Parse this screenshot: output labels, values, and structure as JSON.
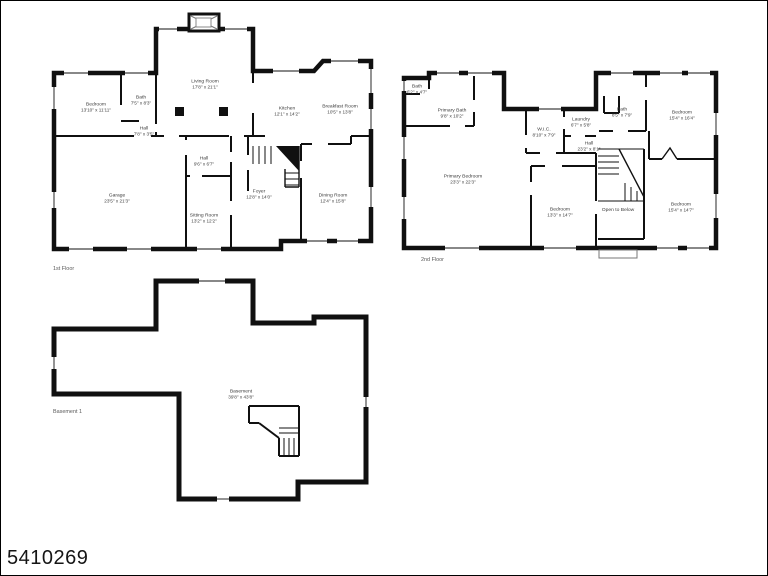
{
  "watermark": "5410269",
  "colors": {
    "walls": "#101010",
    "background": "#ffffff",
    "label_text": "#3c3c3c"
  },
  "floors": {
    "first": {
      "label": "1st Floor",
      "rooms": {
        "bedroom": {
          "name": "Bedroom",
          "dims": "13'10\" x 11'11\""
        },
        "bath": {
          "name": "Bath",
          "dims": "7'5\" x 8'3\""
        },
        "hall_upper": {
          "name": "Hall",
          "dims": "7'8\" x 3'5\""
        },
        "living": {
          "name": "Living Room",
          "dims": "17'8\" x 21'1\""
        },
        "kitchen": {
          "name": "Kitchen",
          "dims": "12'1\" x 14'2\""
        },
        "breakfast": {
          "name": "Breakfast Room",
          "dims": "10'5\" x 13'8\""
        },
        "hall_lower": {
          "name": "Hall",
          "dims": "9'6\" x 6'7\""
        },
        "garage": {
          "name": "Garage",
          "dims": "23'5\" x 21'3\""
        },
        "sitting": {
          "name": "Sitting Room",
          "dims": "13'2\" x 12'2\""
        },
        "foyer": {
          "name": "Foyer",
          "dims": "12'8\" x 14'0\""
        },
        "dining": {
          "name": "Dining Room",
          "dims": "12'4\" x 15'8\""
        }
      }
    },
    "second": {
      "label": "2nd Floor",
      "rooms": {
        "bath_small": {
          "name": "Bath",
          "dims": "6'2\" x 4'7\""
        },
        "primary_bath": {
          "name": "Primary Bath",
          "dims": "9'8\" x 10'2\""
        },
        "wic": {
          "name": "W.I.C.",
          "dims": "8'10\" x 7'9\""
        },
        "laundry": {
          "name": "Laundry",
          "dims": "6'7\" x 5'8\""
        },
        "bath": {
          "name": "Bath",
          "dims": "8'5\" x 7'9\""
        },
        "bedroom_tr": {
          "name": "Bedroom",
          "dims": "15'4\" x 16'4\""
        },
        "hall": {
          "name": "Hall",
          "dims": "23'2\" x 8'1\""
        },
        "primary_bedroom": {
          "name": "Primary Bedroom",
          "dims": "23'3\" x 22'3\""
        },
        "bedroom_bm": {
          "name": "Bedroom",
          "dims": "13'3\" x 14'7\""
        },
        "open_below": {
          "name": "Open to Below"
        },
        "bedroom_br": {
          "name": "Bedroom",
          "dims": "15'4\" x 14'7\""
        }
      }
    },
    "basement": {
      "label": "Basement 1",
      "rooms": {
        "basement": {
          "name": "Basement",
          "dims": "39'8\" x 43'8\""
        }
      }
    }
  }
}
